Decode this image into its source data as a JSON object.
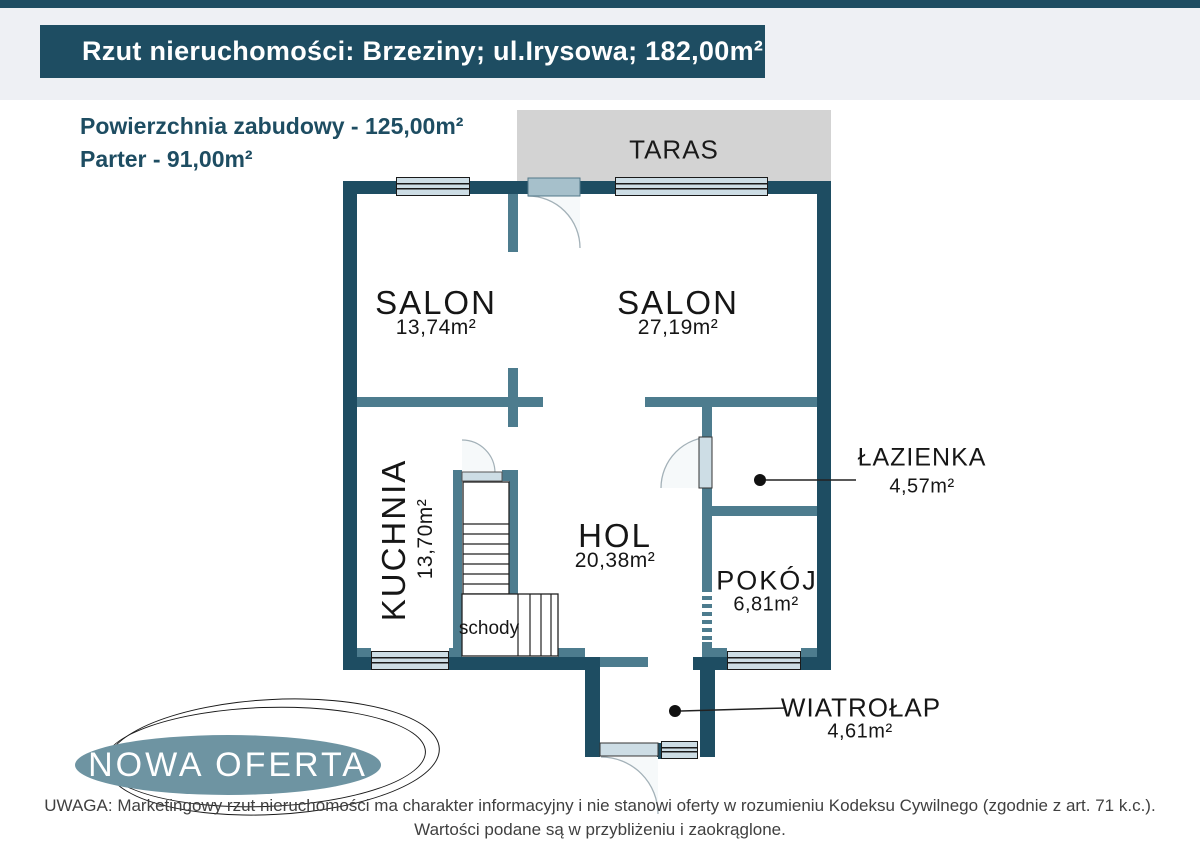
{
  "header": {
    "title": "Rzut nieruchomości: Brzeziny; ul.Irysowa; 182,00m²"
  },
  "summary": {
    "built_area": "Powierzchnia zabudowy - 125,00m²",
    "floor_area": "Parter - 91,00m²"
  },
  "floorplan": {
    "terrace_label": "TARAS",
    "stairs_label": "schody",
    "rooms": {
      "salon1": {
        "name": "SALON",
        "area": "13,74m²"
      },
      "salon2": {
        "name": "SALON",
        "area": "27,19m²"
      },
      "kuchnia": {
        "name": "KUCHNIA",
        "area": "13,70m²"
      },
      "hol": {
        "name": "HOL",
        "area": "20,38m²"
      },
      "lazienka": {
        "name": "ŁAZIENKA",
        "area": "4,57m²"
      },
      "pokoj": {
        "name": "POKÓJ",
        "area": "6,81m²"
      },
      "wiatrolap": {
        "name": "WIATROŁAP",
        "area": "4,61m²"
      }
    }
  },
  "logo": {
    "text": "NOWA OFERTA"
  },
  "disclaimer": {
    "line1": "UWAGA: Marketingowy rzut nieruchomości ma charakter informacyjny i nie stanowi oferty w rozumieniu Kodeksu Cywilnego (zgodnie z art. 71 k.c.).",
    "line2": "Wartości podane są w przybliżeniu i zaokrąglone."
  },
  "colors": {
    "wall_dark": "#1e4d62",
    "wall_light": "#4d7c8e",
    "window_fill": "#cddde5",
    "terrace_gray": "#d3d3d3",
    "background_top": "#eef0f4",
    "logo_fill": "#6e94a2"
  }
}
